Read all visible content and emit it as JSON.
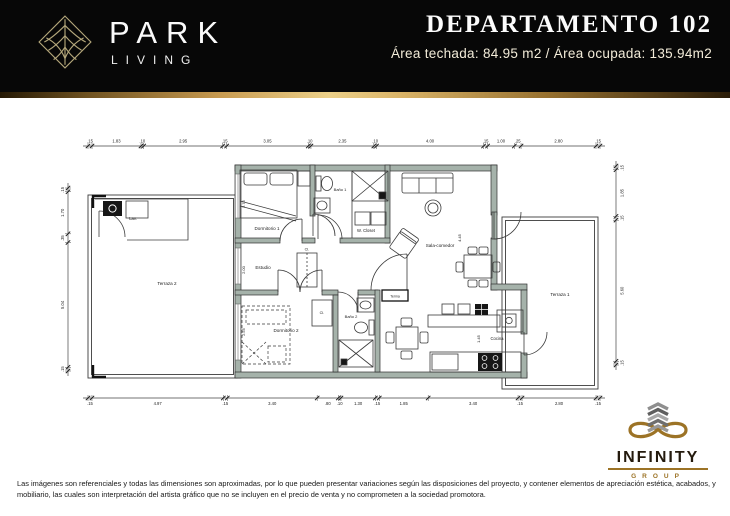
{
  "header": {
    "brand": {
      "name": "PARK",
      "sub": "LIVING"
    },
    "title": "DEPARTAMENTO 102",
    "subtitle": "Área techada: 84.95 m2 / Área ocupada: 135.94m2"
  },
  "colors": {
    "gold": "#c79a50",
    "header_bg": "#070707",
    "wall_fill": "#a5b2aa",
    "line": "#2f2f2f"
  },
  "plan": {
    "rooms": {
      "terraza2": "Terraza 2",
      "lav": "Lav.",
      "dormitorio1": "Dormitorio 1",
      "bano1": "Baño 1",
      "wcloset": "W. Closet",
      "estudio": "Estudio",
      "cl1": "Cl.",
      "dormitorio2": "Dormitorio 2",
      "cl2": "Cl.",
      "bano2": "Baño 2",
      "terma": "Terma",
      "sala": "Sala-comedor",
      "cocina": "Cocina",
      "terraza1": "Terraza 1"
    },
    "dimensions": {
      "top": [
        ".15",
        "1.83",
        ".10",
        "2.95",
        ".15",
        "3.05",
        ".10",
        "2.35",
        ".10",
        "4.00",
        ".15",
        "1.00",
        ".25",
        "2.80",
        ".15"
      ],
      "bottom": [
        ".15",
        "4.97",
        ".15",
        "3.40",
        ".80",
        ".10",
        "1.30",
        ".15",
        "1.85",
        "3.40",
        ".15",
        "2.80",
        ".15"
      ],
      "left": [
        ".15",
        "1.70",
        ".35",
        "5.04",
        ".15"
      ],
      "right": [
        ".15",
        "1.85",
        ".15",
        "5.60",
        ".15"
      ]
    },
    "interior_dims": {
      "d1": "2.75",
      "d2": "2.00",
      "d3": "2.55",
      "d4": "4.45",
      "d5": "1.45"
    }
  },
  "footer": {
    "disclaimer": "Las imágenes son referenciales y todas las dimensiones son aproximadas, por lo que pueden presentar variaciones según las disposiciones del proyecto, y contener elementos de apreciación estética, acabados, y mobiliario, las cuales son interpretación del artista gráfico que no se incluyen en el precio de venta y no comprometen a la sociedad promotora.",
    "infinity": {
      "name": "INFINITY",
      "group": "GROUP"
    }
  }
}
